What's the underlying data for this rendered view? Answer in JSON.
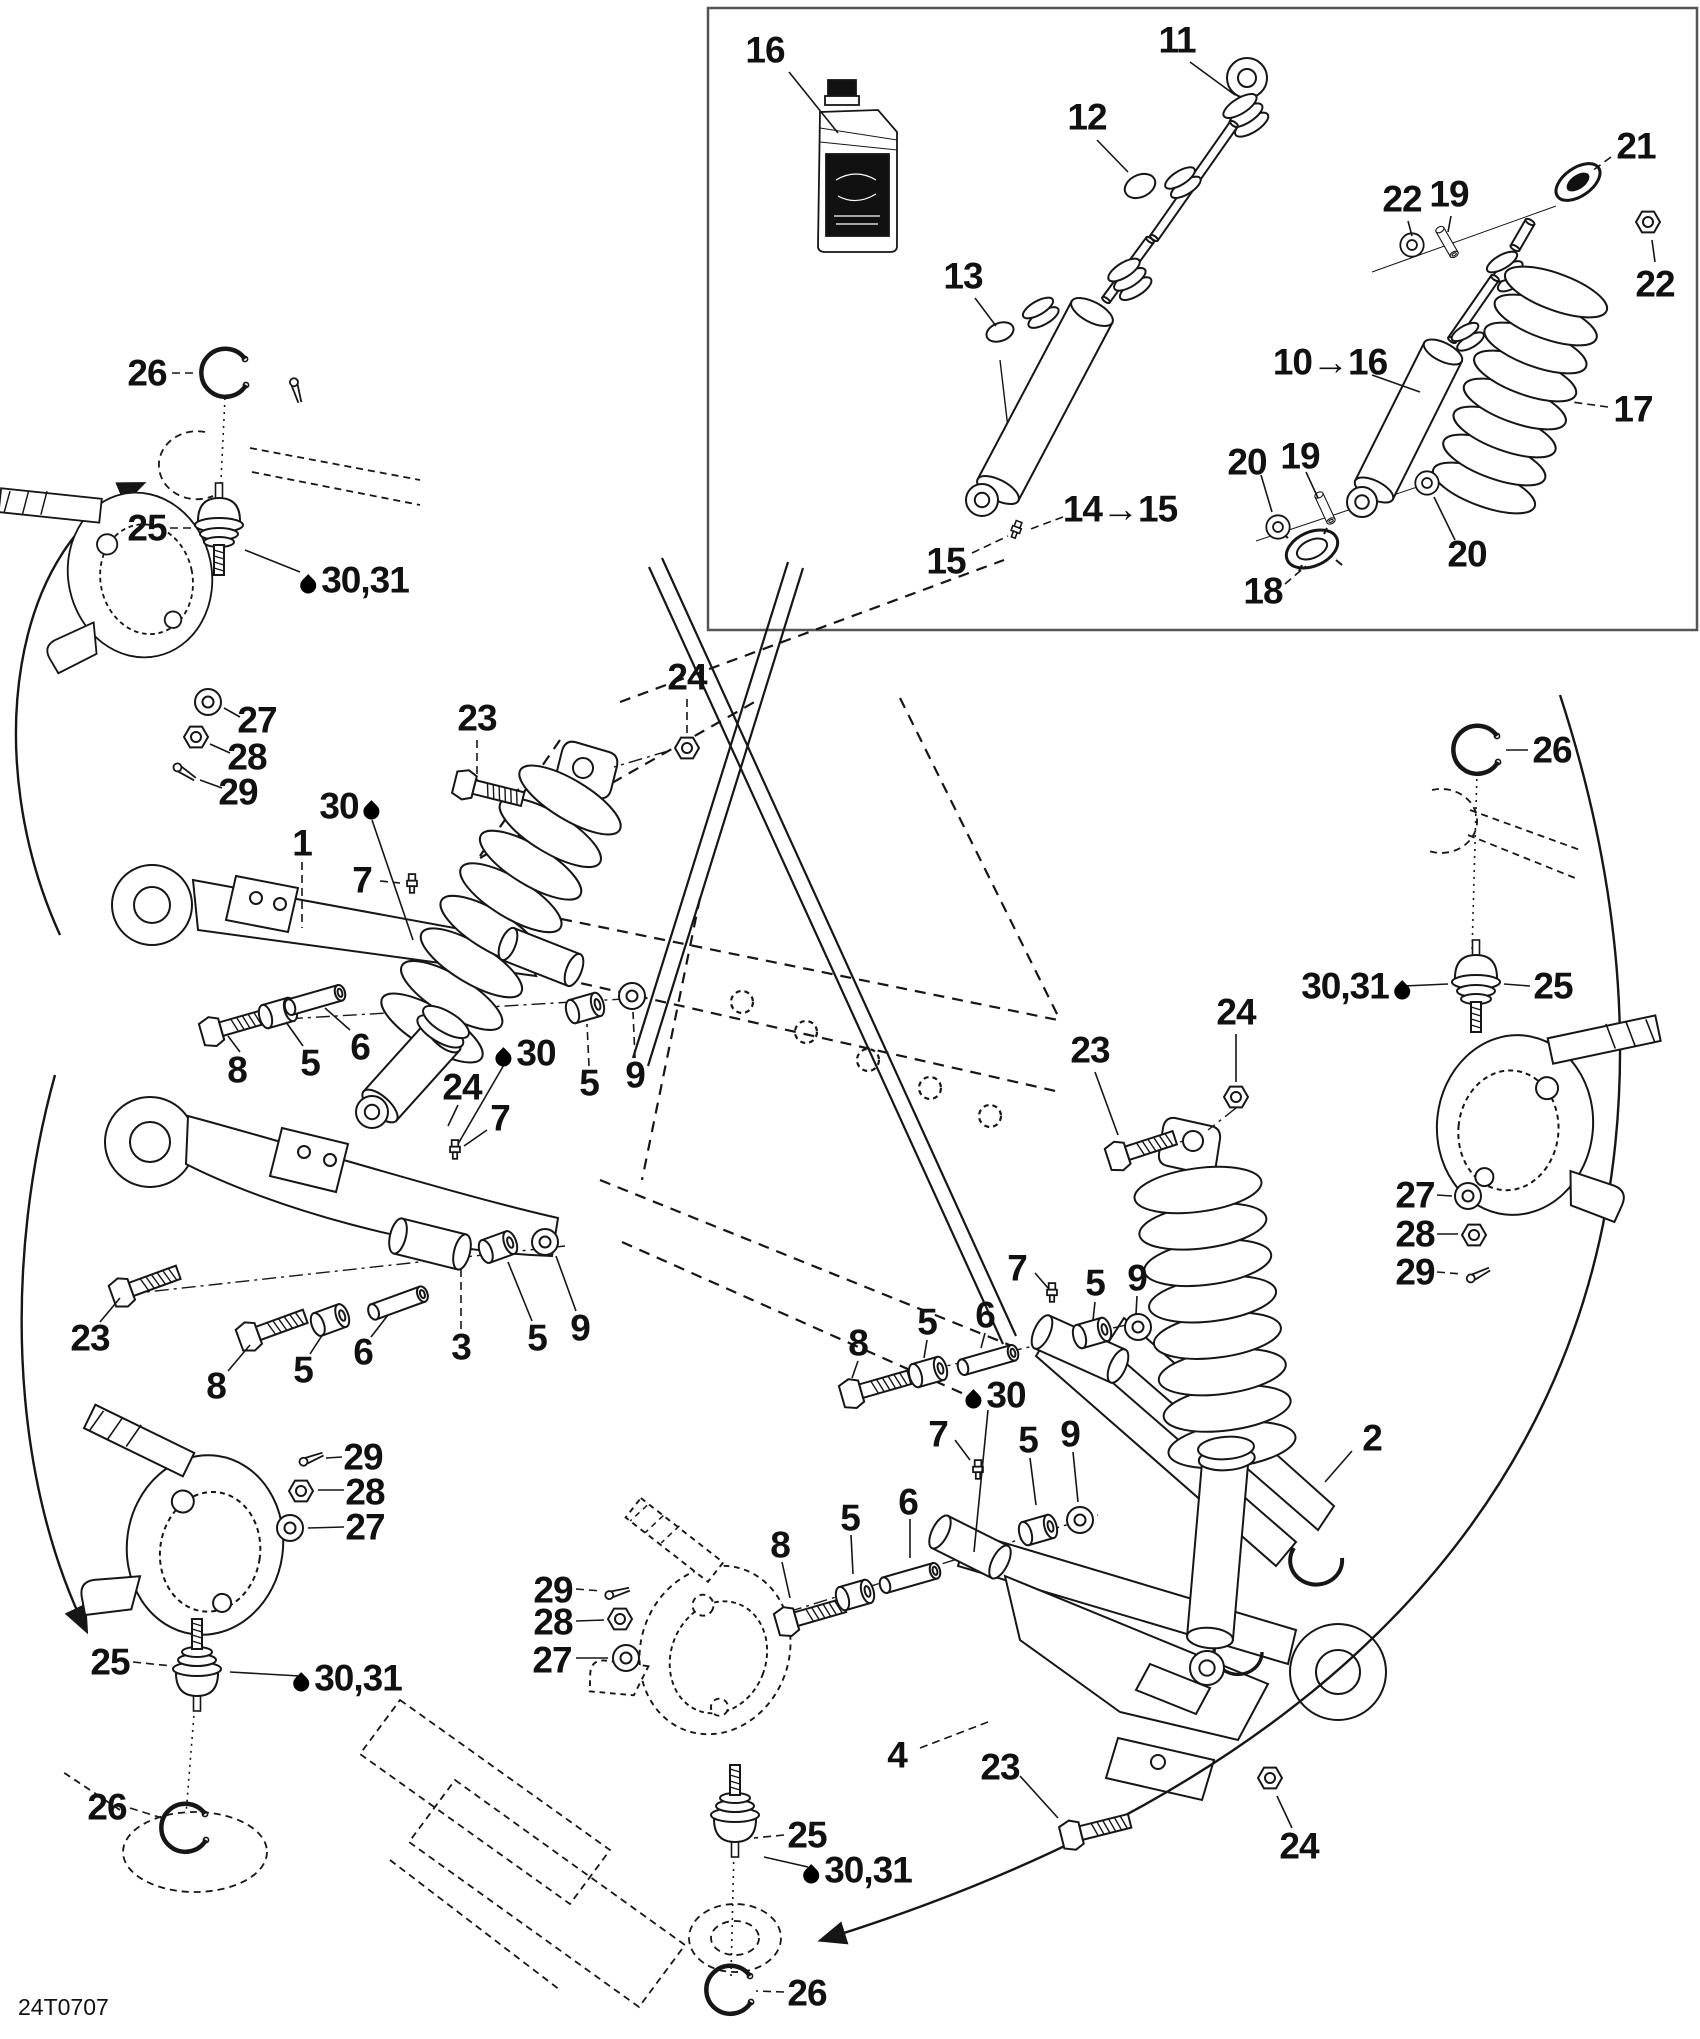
{
  "diagram": {
    "part_code": "24T0707",
    "background_color": "#ffffff",
    "line_color": "#161616",
    "inset_border_color": "#555555"
  },
  "icons": {
    "drop": "oil-drop-icon"
  },
  "callouts": [
    {
      "t": "16",
      "x": 765,
      "y": 50,
      "l": [
        789,
        72,
        838,
        133
      ]
    },
    {
      "t": "11",
      "x": 1177,
      "y": 40,
      "l": [
        1190,
        62,
        1235,
        95
      ]
    },
    {
      "t": "12",
      "x": 1087,
      "y": 117,
      "l": [
        1097,
        140,
        1128,
        172
      ]
    },
    {
      "t": "13",
      "x": 963,
      "y": 276,
      "l": [
        975,
        298,
        996,
        326
      ]
    },
    {
      "t": "14→15",
      "x": 1120,
      "y": 509,
      "l": [
        1063,
        517,
        1028,
        530
      ],
      "ds": 1
    },
    {
      "t": "15",
      "x": 946,
      "y": 561,
      "l": [
        972,
        553,
        1008,
        536
      ],
      "ds": 1
    },
    {
      "t": "22",
      "x": 1402,
      "y": 199,
      "l": [
        1408,
        221,
        1412,
        236
      ]
    },
    {
      "t": "19",
      "x": 1449,
      "y": 194,
      "l": [
        1451,
        216,
        1448,
        232
      ]
    },
    {
      "t": "21",
      "x": 1636,
      "y": 146,
      "l": [
        1611,
        157,
        1592,
        171
      ],
      "ds": 1
    },
    {
      "t": "22",
      "x": 1655,
      "y": 284,
      "l": [
        1655,
        262,
        1652,
        240
      ]
    },
    {
      "t": "10→16",
      "x": 1330,
      "y": 362,
      "l": [
        1372,
        375,
        1420,
        392
      ]
    },
    {
      "t": "17",
      "x": 1633,
      "y": 409,
      "l": [
        1608,
        407,
        1572,
        402
      ],
      "ds": 1
    },
    {
      "t": "20",
      "x": 1247,
      "y": 462,
      "l": [
        1261,
        475,
        1272,
        512
      ]
    },
    {
      "t": "19",
      "x": 1300,
      "y": 456,
      "l": [
        1306,
        472,
        1318,
        498
      ]
    },
    {
      "t": "20",
      "x": 1467,
      "y": 554,
      "l": [
        1455,
        540,
        1434,
        497
      ]
    },
    {
      "t": "18",
      "x": 1263,
      "y": 591,
      "l": [
        1285,
        584,
        1306,
        566
      ],
      "ds": 1
    },
    {
      "t": "26",
      "x": 147,
      "y": 373,
      "l": [
        172,
        373,
        198,
        373
      ],
      "ds": 1
    },
    {
      "t": "25",
      "x": 147,
      "y": 528,
      "l": [
        170,
        528,
        194,
        528
      ],
      "ds": 1
    },
    {
      "t": "30,31",
      "x": 352,
      "y": 580,
      "d": "l",
      "l": [
        300,
        572,
        245,
        550
      ]
    },
    {
      "t": "27",
      "x": 257,
      "y": 720,
      "l": [
        240,
        717,
        224,
        708
      ]
    },
    {
      "t": "28",
      "x": 247,
      "y": 757,
      "l": [
        230,
        753,
        210,
        744
      ]
    },
    {
      "t": "29",
      "x": 238,
      "y": 792,
      "l": [
        222,
        788,
        200,
        780
      ]
    },
    {
      "t": "1",
      "x": 302,
      "y": 843,
      "l": [
        302,
        862,
        302,
        928
      ],
      "ds": 1
    },
    {
      "t": "30",
      "x": 352,
      "y": 806,
      "d": "r",
      "l": [
        372,
        820,
        413,
        940
      ]
    },
    {
      "t": "7",
      "x": 362,
      "y": 880,
      "l": [
        380,
        881,
        400,
        883
      ],
      "ds": 1
    },
    {
      "t": "23",
      "x": 477,
      "y": 718,
      "l": [
        477,
        740,
        477,
        780
      ],
      "ds": 1
    },
    {
      "t": "24",
      "x": 687,
      "y": 677,
      "l": [
        687,
        699,
        687,
        738
      ],
      "ds": 1
    },
    {
      "t": "8",
      "x": 237,
      "y": 1070,
      "l": [
        240,
        1052,
        228,
        1036
      ]
    },
    {
      "t": "5",
      "x": 310,
      "y": 1063,
      "l": [
        303,
        1046,
        286,
        1022
      ]
    },
    {
      "t": "6",
      "x": 360,
      "y": 1047,
      "l": [
        350,
        1030,
        325,
        1008
      ]
    },
    {
      "t": "30",
      "x": 523,
      "y": 1053,
      "d": "l",
      "l": [
        505,
        1063,
        458,
        1144
      ]
    },
    {
      "t": "24",
      "x": 462,
      "y": 1087,
      "l": [
        458,
        1105,
        448,
        1126
      ]
    },
    {
      "t": "7",
      "x": 500,
      "y": 1118,
      "l": [
        487,
        1130,
        464,
        1146
      ]
    },
    {
      "t": "5",
      "x": 589,
      "y": 1083,
      "l": [
        589,
        1066,
        587,
        1024
      ],
      "ds": 1
    },
    {
      "t": "9",
      "x": 635,
      "y": 1075,
      "l": [
        635,
        1058,
        633,
        1012
      ],
      "ds": 1
    },
    {
      "t": "23",
      "x": 90,
      "y": 1338,
      "l": [
        100,
        1322,
        120,
        1298
      ]
    },
    {
      "t": "8",
      "x": 216,
      "y": 1386,
      "l": [
        228,
        1371,
        250,
        1345
      ]
    },
    {
      "t": "5",
      "x": 303,
      "y": 1370,
      "l": [
        310,
        1354,
        323,
        1334
      ]
    },
    {
      "t": "6",
      "x": 363,
      "y": 1352,
      "l": [
        371,
        1337,
        388,
        1315
      ]
    },
    {
      "t": "3",
      "x": 461,
      "y": 1347,
      "l": [
        461,
        1329,
        461,
        1268
      ],
      "ds": 1
    },
    {
      "t": "5",
      "x": 537,
      "y": 1338,
      "l": [
        532,
        1321,
        508,
        1262
      ]
    },
    {
      "t": "9",
      "x": 580,
      "y": 1328,
      "l": [
        576,
        1311,
        556,
        1256
      ]
    },
    {
      "t": "29",
      "x": 363,
      "y": 1457,
      "l": [
        342,
        1457,
        326,
        1458
      ]
    },
    {
      "t": "28",
      "x": 365,
      "y": 1492,
      "l": [
        344,
        1490,
        318,
        1490
      ]
    },
    {
      "t": "27",
      "x": 365,
      "y": 1527,
      "l": [
        344,
        1527,
        308,
        1528
      ]
    },
    {
      "t": "25",
      "x": 110,
      "y": 1662,
      "l": [
        133,
        1662,
        172,
        1666
      ],
      "ds": 1
    },
    {
      "t": "30,31",
      "x": 345,
      "y": 1678,
      "d": "l",
      "l": [
        300,
        1676,
        230,
        1672
      ]
    },
    {
      "t": "26",
      "x": 107,
      "y": 1807,
      "l": [
        130,
        1808,
        162,
        1818
      ],
      "ds": 1
    },
    {
      "t": "29",
      "x": 553,
      "y": 1590,
      "l": [
        576,
        1589,
        602,
        1591
      ],
      "ds": 1
    },
    {
      "t": "28",
      "x": 553,
      "y": 1622,
      "l": [
        576,
        1621,
        604,
        1620
      ]
    },
    {
      "t": "27",
      "x": 552,
      "y": 1660,
      "l": [
        576,
        1658,
        608,
        1658
      ]
    },
    {
      "t": "25",
      "x": 807,
      "y": 1835,
      "l": [
        784,
        1835,
        754,
        1838
      ],
      "ds": 1
    },
    {
      "t": "30,31",
      "x": 855,
      "y": 1870,
      "d": "l",
      "l": [
        808,
        1867,
        764,
        1857
      ]
    },
    {
      "t": "26",
      "x": 807,
      "y": 1993,
      "l": [
        784,
        1992,
        756,
        1991
      ],
      "ds": 1
    },
    {
      "t": "26",
      "x": 1552,
      "y": 750,
      "l": [
        1528,
        750,
        1506,
        750
      ]
    },
    {
      "t": "30,31",
      "x": 1358,
      "y": 986,
      "d": "r",
      "l": [
        1404,
        986,
        1448,
        984
      ]
    },
    {
      "t": "25",
      "x": 1553,
      "y": 986,
      "l": [
        1530,
        986,
        1504,
        984
      ]
    },
    {
      "t": "27",
      "x": 1415,
      "y": 1195,
      "l": [
        1437,
        1195,
        1452,
        1196
      ]
    },
    {
      "t": "28",
      "x": 1415,
      "y": 1234,
      "l": [
        1437,
        1234,
        1458,
        1234
      ]
    },
    {
      "t": "29",
      "x": 1415,
      "y": 1272,
      "l": [
        1437,
        1272,
        1462,
        1274
      ],
      "ds": 1
    },
    {
      "t": "23",
      "x": 1090,
      "y": 1050,
      "l": [
        1095,
        1072,
        1118,
        1135
      ]
    },
    {
      "t": "24",
      "x": 1236,
      "y": 1012,
      "l": [
        1236,
        1034,
        1236,
        1082
      ]
    },
    {
      "t": "30",
      "x": 993,
      "y": 1395,
      "d": "l",
      "l": [
        988,
        1410,
        974,
        1552
      ]
    },
    {
      "t": "7",
      "x": 1017,
      "y": 1268,
      "l": [
        1035,
        1273,
        1048,
        1288
      ]
    },
    {
      "t": "5",
      "x": 1095,
      "y": 1283,
      "l": [
        1095,
        1302,
        1093,
        1320
      ]
    },
    {
      "t": "9",
      "x": 1137,
      "y": 1278,
      "l": [
        1137,
        1296,
        1136,
        1314
      ]
    },
    {
      "t": "6",
      "x": 985,
      "y": 1315,
      "l": [
        985,
        1333,
        981,
        1348
      ]
    },
    {
      "t": "5",
      "x": 927,
      "y": 1322,
      "l": [
        927,
        1340,
        924,
        1358
      ]
    },
    {
      "t": "8",
      "x": 858,
      "y": 1343,
      "l": [
        858,
        1361,
        852,
        1378
      ]
    },
    {
      "t": "7",
      "x": 938,
      "y": 1434,
      "l": [
        955,
        1440,
        970,
        1460
      ]
    },
    {
      "t": "5",
      "x": 1028,
      "y": 1440,
      "l": [
        1030,
        1458,
        1036,
        1505
      ]
    },
    {
      "t": "9",
      "x": 1070,
      "y": 1434,
      "l": [
        1073,
        1452,
        1078,
        1502
      ]
    },
    {
      "t": "6",
      "x": 908,
      "y": 1502,
      "l": [
        910,
        1519,
        910,
        1558
      ]
    },
    {
      "t": "5",
      "x": 850,
      "y": 1518,
      "l": [
        851,
        1535,
        853,
        1574
      ]
    },
    {
      "t": "8",
      "x": 780,
      "y": 1545,
      "l": [
        782,
        1562,
        790,
        1598
      ]
    },
    {
      "t": "2",
      "x": 1372,
      "y": 1438,
      "l": [
        1352,
        1451,
        1325,
        1482
      ]
    },
    {
      "t": "23",
      "x": 1000,
      "y": 1767,
      "l": [
        1020,
        1776,
        1058,
        1818
      ]
    },
    {
      "t": "24",
      "x": 1299,
      "y": 1846,
      "l": [
        1292,
        1828,
        1277,
        1796
      ]
    },
    {
      "t": "4",
      "x": 897,
      "y": 1755,
      "l": [
        920,
        1748,
        988,
        1722
      ],
      "ds": 1
    }
  ]
}
